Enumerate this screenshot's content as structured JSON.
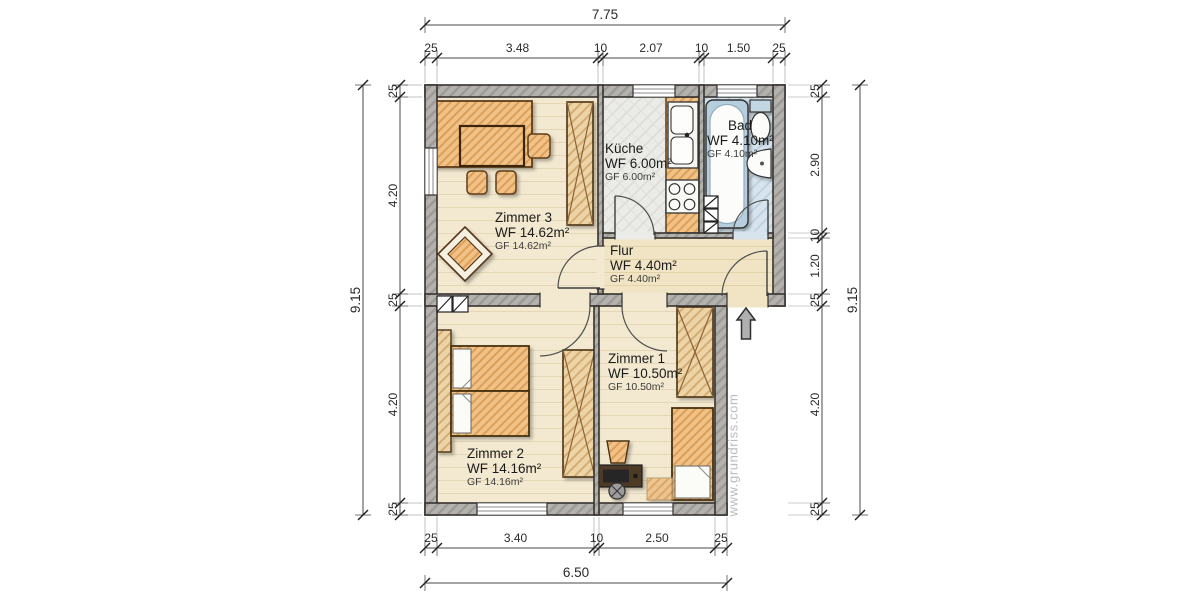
{
  "plan": {
    "watermark": "www.grundriss.com"
  },
  "rooms": [
    {
      "name": "Zimmer 3",
      "wf": "WF 14.62m²",
      "gf": "GF 14.62m²"
    },
    {
      "name": "Küche",
      "wf": "WF 6.00m²",
      "gf": "GF 6.00m²"
    },
    {
      "name": "Bad",
      "wf": "WF 4.10m²",
      "gf": "GF 4.10m²"
    },
    {
      "name": "Flur",
      "wf": "WF 4.40m²",
      "gf": "GF 4.40m²"
    },
    {
      "name": "Zimmer 1",
      "wf": "WF 10.50m²",
      "gf": "GF 10.50m²"
    },
    {
      "name": "Zimmer 2",
      "wf": "WF 14.16m²",
      "gf": "GF 14.16m²"
    }
  ],
  "dimensions": {
    "top": {
      "total": "7.75",
      "chain": [
        "25",
        "3.48",
        "10",
        "2.07",
        "10",
        "1.50",
        "25"
      ]
    },
    "bottom": {
      "total": "6.50",
      "chain": [
        "25",
        "3.40",
        "10",
        "2.50",
        "25"
      ]
    },
    "left": {
      "total": "9.15",
      "chain": [
        "25",
        "4.20",
        "25",
        "4.20",
        "25"
      ]
    },
    "right": {
      "total": "9.15",
      "chain": [
        "25",
        "2.90",
        "10",
        "1.20",
        "25",
        "4.20",
        "25"
      ]
    }
  },
  "colors": {
    "wall": "#b4b2af",
    "room_floor": "#f3e9d1",
    "kitchen_floor": "#ebebe8",
    "bath_floor": "#d7e4ee",
    "furniture_wood": "#f0c287",
    "bath_fixture": "#b6cede",
    "outline": "#36332f"
  }
}
